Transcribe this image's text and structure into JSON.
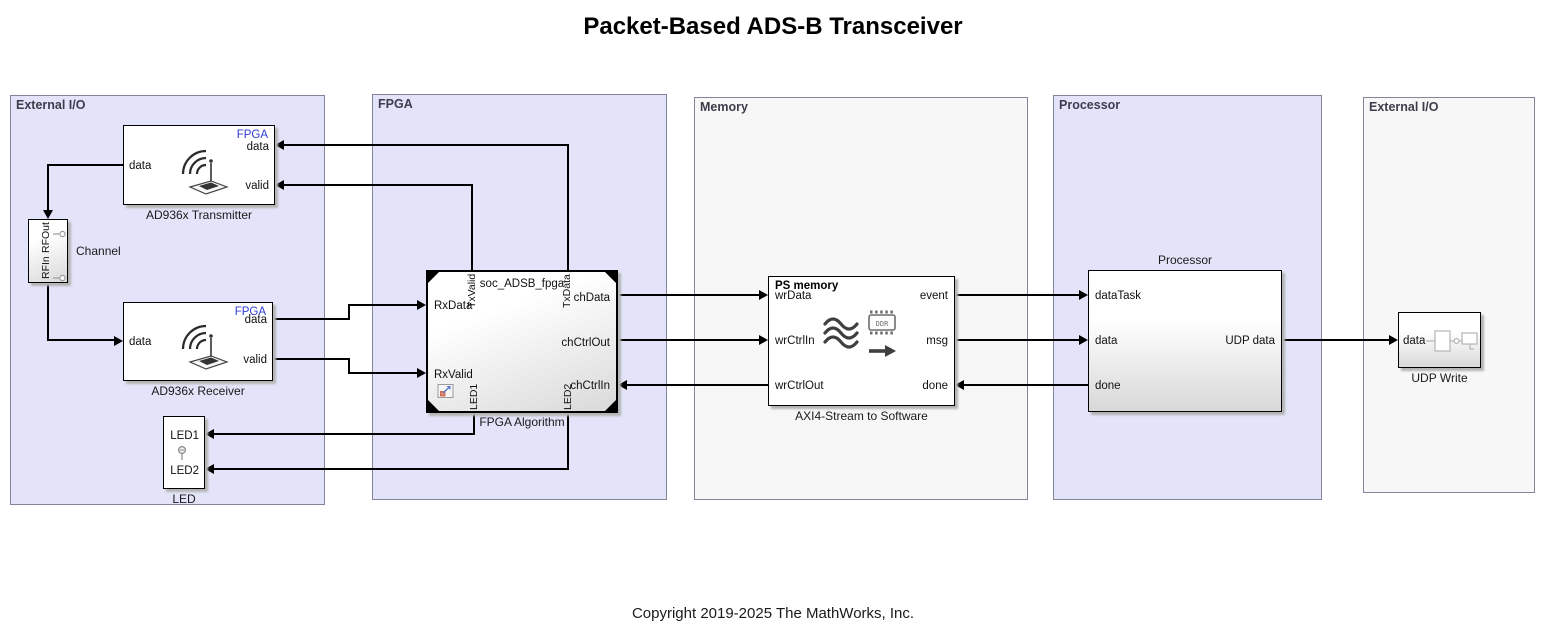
{
  "title": "Packet-Based ADS-B Transceiver",
  "copyright": "Copyright 2019-2025 The MathWorks, Inc.",
  "colors": {
    "area_blue": "#e3e4f9",
    "area_gray": "#f7f7f7",
    "area_border": "#84849a",
    "fpga_tag_blue": "#2d3bd3",
    "wire": "#000000"
  },
  "areas": {
    "ext_io_left": "External I/O",
    "fpga": "FPGA",
    "memory": "Memory",
    "processor": "Processor",
    "ext_io_right": "External I/O"
  },
  "transmitter": {
    "label": "AD936x Transmitter",
    "tag": "FPGA",
    "port_data_out": "data",
    "port_data_in": "data",
    "port_valid_in": "valid"
  },
  "channel": {
    "label": "Channel",
    "port_top": "RFOut",
    "port_bottom": "RFIn"
  },
  "receiver": {
    "label": "AD936x Receiver",
    "tag": "FPGA",
    "port_data_in": "data",
    "port_data_out": "data",
    "port_valid_out": "valid"
  },
  "led": {
    "label": "LED",
    "port1": "LED1",
    "port2": "LED2"
  },
  "fpga_algorithm": {
    "label": "FPGA Algorithm",
    "title": "soc_ADSB_fpga",
    "port_tx_valid": "TxValid",
    "port_tx_data": "TxData",
    "port_rx_data": "RxData",
    "port_rx_valid": "RxValid",
    "port_ch_data": "chData",
    "port_ch_ctrl_out": "chCtrlOut",
    "port_ch_ctrl_in": "chCtrlIn",
    "port_led1": "LED1",
    "port_led2": "LED2"
  },
  "axi4_stream": {
    "label": "AXI4-Stream to Software",
    "title": "PS memory",
    "chip_label": "DDR",
    "port_wr_data": "wrData",
    "port_wr_ctrl_in": "wrCtrlIn",
    "port_wr_ctrl_out": "wrCtrlOut",
    "port_event": "event",
    "port_msg": "msg",
    "port_done": "done"
  },
  "processor": {
    "label": "Processor",
    "port_data_task": "dataTask",
    "port_data": "data",
    "port_done": "done",
    "port_udp_data": "UDP data"
  },
  "udp_write": {
    "label": "UDP Write",
    "port_data": "data"
  }
}
